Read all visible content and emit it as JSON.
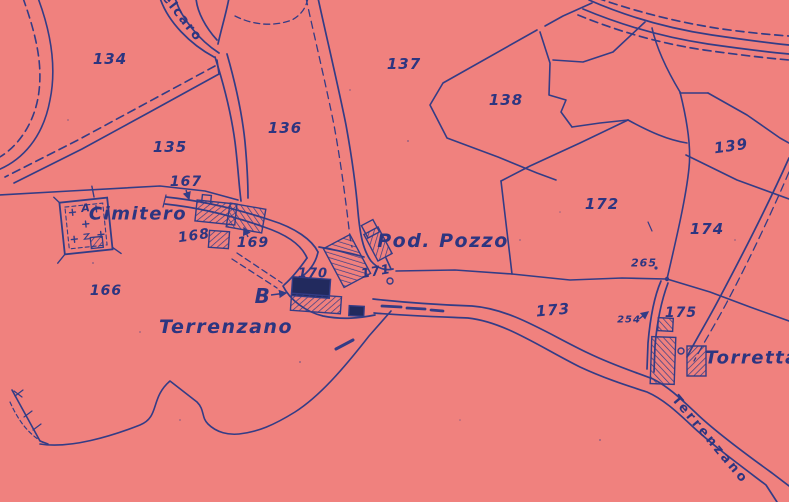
{
  "map": {
    "type": "cadastral-map-scan",
    "colors": {
      "background": "#f0817e",
      "ink": "#333c86",
      "building_fill": "#222a5e",
      "text": "#2d3580"
    },
    "labels": {
      "parcels": [
        "134",
        "135",
        "136",
        "137",
        "138",
        "139",
        "166",
        "167",
        "168",
        "169",
        "170",
        "171",
        "172",
        "173",
        "174",
        "175"
      ],
      "points": {
        "p265": "265",
        "p254": "254"
      },
      "places": {
        "cimitero": "Cimitero",
        "terrenzano": "Terrenzano",
        "pod_pozzo": "Pod. Pozzo",
        "torretta": "Torretta",
        "b_marker": "B",
        "a_marker": "A"
      },
      "roads": {
        "belcaro": "elcaro",
        "terrenzano_road": "Terrenzano"
      }
    },
    "features": {
      "cemetery": "walled cemetery with crosses",
      "wells": 2,
      "solid_buildings": 2,
      "hatched_buildings": 9
    }
  }
}
